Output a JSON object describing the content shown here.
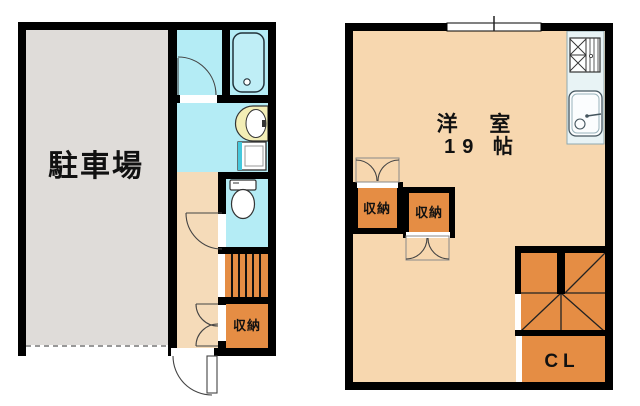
{
  "page_title": "Maisonette floor plan (1F / 2F)",
  "palette": {
    "wall": "#000000",
    "parking_gray": "#dfdcd9",
    "hallway_floor": "#f5dbb9",
    "room_floor": "#f7d7af",
    "storage_orange": "#e58d44",
    "wet_area_cyan": "#b4ecf5",
    "kitchen_counter": "#e8f3f5",
    "vanity_yellow": "#f3eeb6",
    "washer_teal": "#45c8dc",
    "tub_cyan": "#bfeef6"
  },
  "floor1": {
    "parking_label": "駐車場",
    "storage_label": "収納",
    "fixture_icons": [
      "bathtub-icon",
      "vanity-sink-icon",
      "washing-machine-icon",
      "toilet-icon",
      "straight-stairs",
      "entrance-door"
    ]
  },
  "floor2": {
    "room_name": "洋 室",
    "room_size": "19 帖",
    "storage_labels": [
      "収納",
      "収納"
    ],
    "closet_label": "CL",
    "fixture_icons": [
      "stove-icon",
      "kitchen-sink-icon",
      "winder-stairs",
      "window",
      "double-doors"
    ]
  }
}
